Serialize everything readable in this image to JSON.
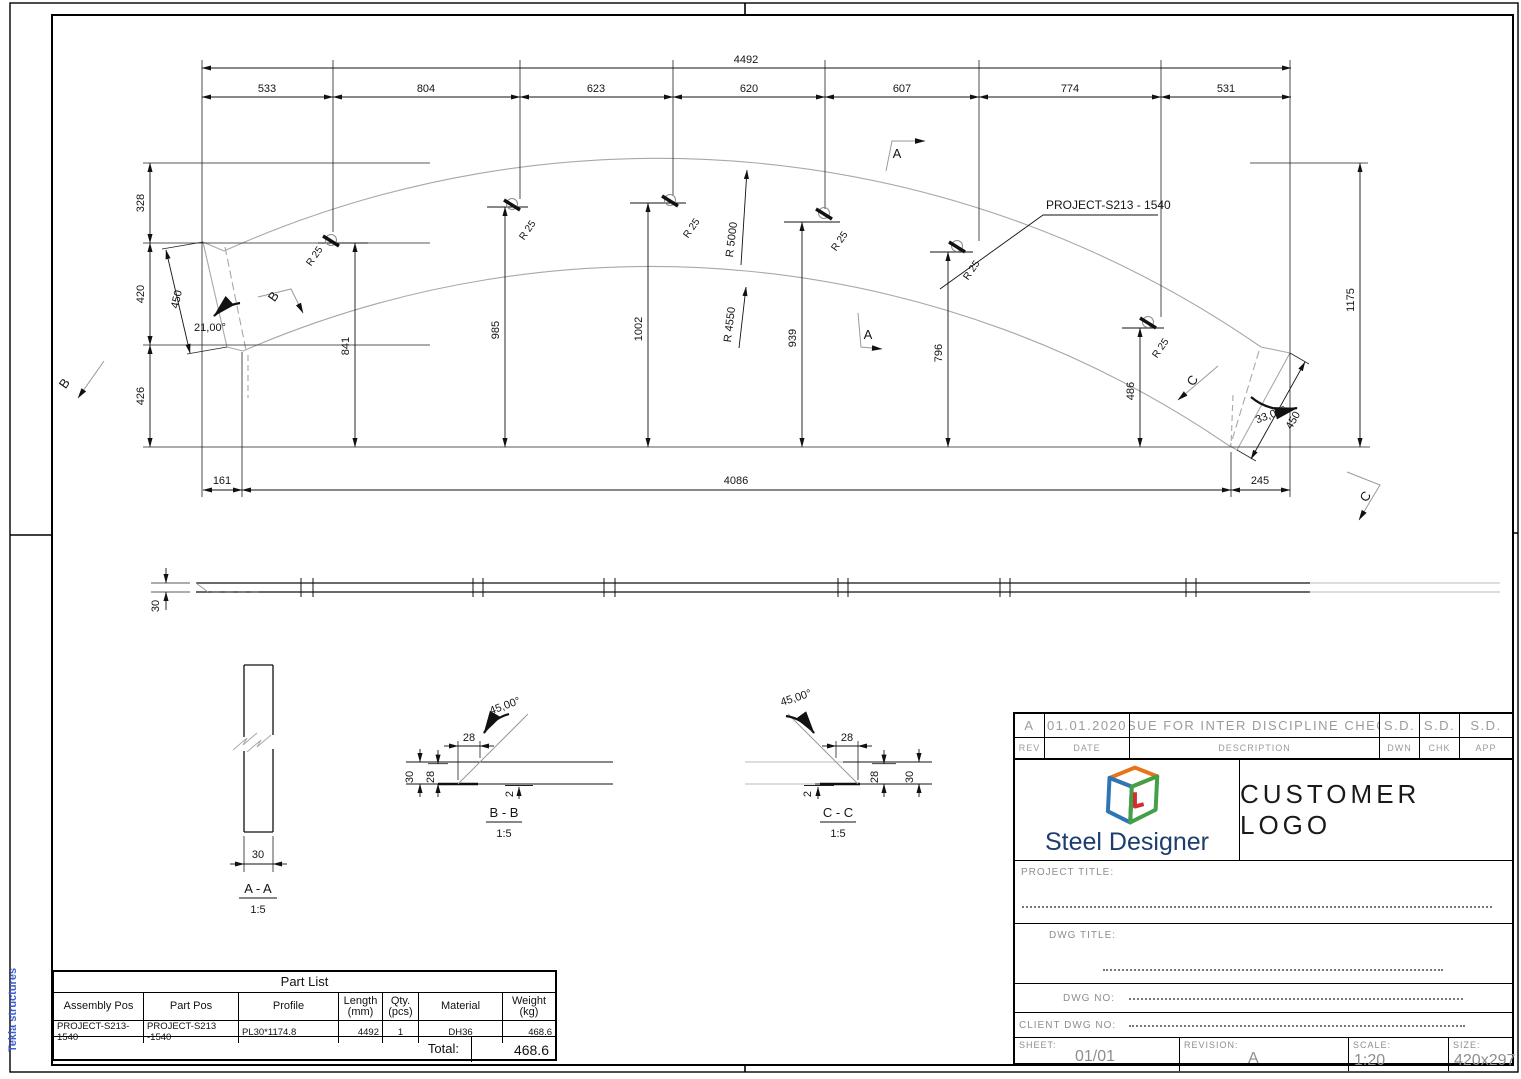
{
  "colors": {
    "accent_orange": "#E8731A",
    "accent_blue": "#2E75B6",
    "accent_green": "#43A047",
    "accent_red": "#D32F2F",
    "logo_navy": "#1C3D6E",
    "tekla_blue": "#3D5FD0",
    "outline_gray": "#A8A8A8",
    "titleblock_gray": "#8E8E8E"
  },
  "frame": {
    "tekla": "Tekla structures"
  },
  "dims": {
    "total": "4492",
    "segments": [
      "533",
      "804",
      "623",
      "620",
      "607",
      "774",
      "531"
    ],
    "left_chain": [
      "328",
      "420",
      "426"
    ],
    "heights": [
      "841",
      "985",
      "1002",
      "939",
      "796",
      "486"
    ],
    "right_height": "1175",
    "bottom": [
      "161",
      "4086",
      "245"
    ],
    "end_width_left": "450",
    "end_width_right": "450",
    "angle_left": "21,00°",
    "angle_right": "33,00°",
    "r_outer": "R 5000",
    "r_inner": "R 4550",
    "r_bend": "R 25",
    "thickness": "30"
  },
  "labels": {
    "part": "PROJECT-S213 - 1540",
    "a": "A",
    "b": "B",
    "c": "C"
  },
  "sections": {
    "aa": {
      "title": "A - A",
      "scale": "1:5",
      "width": "30"
    },
    "bb": {
      "title": "B - B",
      "scale": "1:5",
      "angle": "45,00°",
      "offset": "28",
      "t1": "30",
      "t2": "28",
      "root": "2"
    },
    "cc": {
      "title": "C - C",
      "scale": "1:5",
      "angle": "45,00°",
      "offset": "28",
      "t1": "28",
      "t2": "30",
      "root": "2"
    }
  },
  "part_list": {
    "title": "Part List",
    "headers": [
      {
        "t": "Assembly Pos"
      },
      {
        "t": "Part Pos"
      },
      {
        "t": "Profile"
      },
      {
        "t": "Length",
        "s": "(mm)"
      },
      {
        "t": "Qty.",
        "s": "(pcs)"
      },
      {
        "t": "Material"
      },
      {
        "t": "Weight",
        "s": "(kg)"
      }
    ],
    "row": [
      "PROJECT-S213-1540",
      "PROJECT-S213 -1540",
      "PL30*1174.8",
      "4492",
      "1",
      "DH36",
      "468.6"
    ],
    "total_label": "Total:",
    "total_value": "468.6"
  },
  "title_block": {
    "rev_value": "A",
    "date_value": "01.01.2020",
    "description_value": "ISSUE FOR INTER DISCIPLINE CHECK",
    "dwn_value": "S.D.",
    "chk_value": "S.D.",
    "app_value": "S.D.",
    "rev": "REV",
    "date": "DATE",
    "description": "DESCRIPTION",
    "dwn": "DWN",
    "chk": "CHK",
    "app": "APP",
    "logo_text": "Steel Designer",
    "customer_logo": "CUSTOMER LOGO",
    "project_title": "PROJECT TITLE:",
    "dwg_title": "DWG TITLE:",
    "dwg_no": "DWG NO:",
    "client_dwg_no": "CLIENT DWG NO:",
    "sheet_label": "SHEET:",
    "sheet": "01/01",
    "revision_label": "REVISION:",
    "revision": "A",
    "scale_label": "SCALE:",
    "scale": "1:20",
    "size_label": "SIZE:",
    "size": "420x297"
  }
}
